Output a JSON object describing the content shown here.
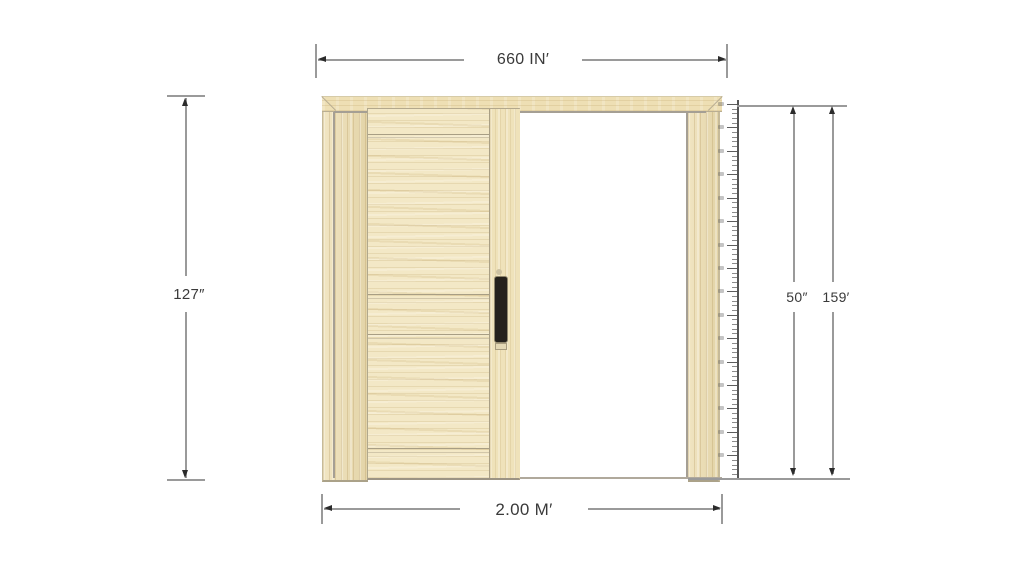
{
  "diagram": {
    "dimensions": {
      "top": {
        "label": "660 IN′"
      },
      "left": {
        "label": "127″"
      },
      "bottom": {
        "label": "2.00 M′"
      },
      "right_inner": {
        "label": "50″"
      },
      "right_outer": {
        "label": "159′"
      }
    },
    "ruler": {
      "orientation": "vertical",
      "tick_count": 80,
      "major_every": 5
    },
    "colors": {
      "wood_frame": "#ecdcae",
      "wood_panel": "#f3e8c6",
      "track_gray": "#a59f94",
      "handle": "#25211c",
      "dimension_line": "#9a9a9a",
      "arrow": "#2b2b2b",
      "text": "#3a3a3a",
      "background": "#ffffff"
    }
  }
}
